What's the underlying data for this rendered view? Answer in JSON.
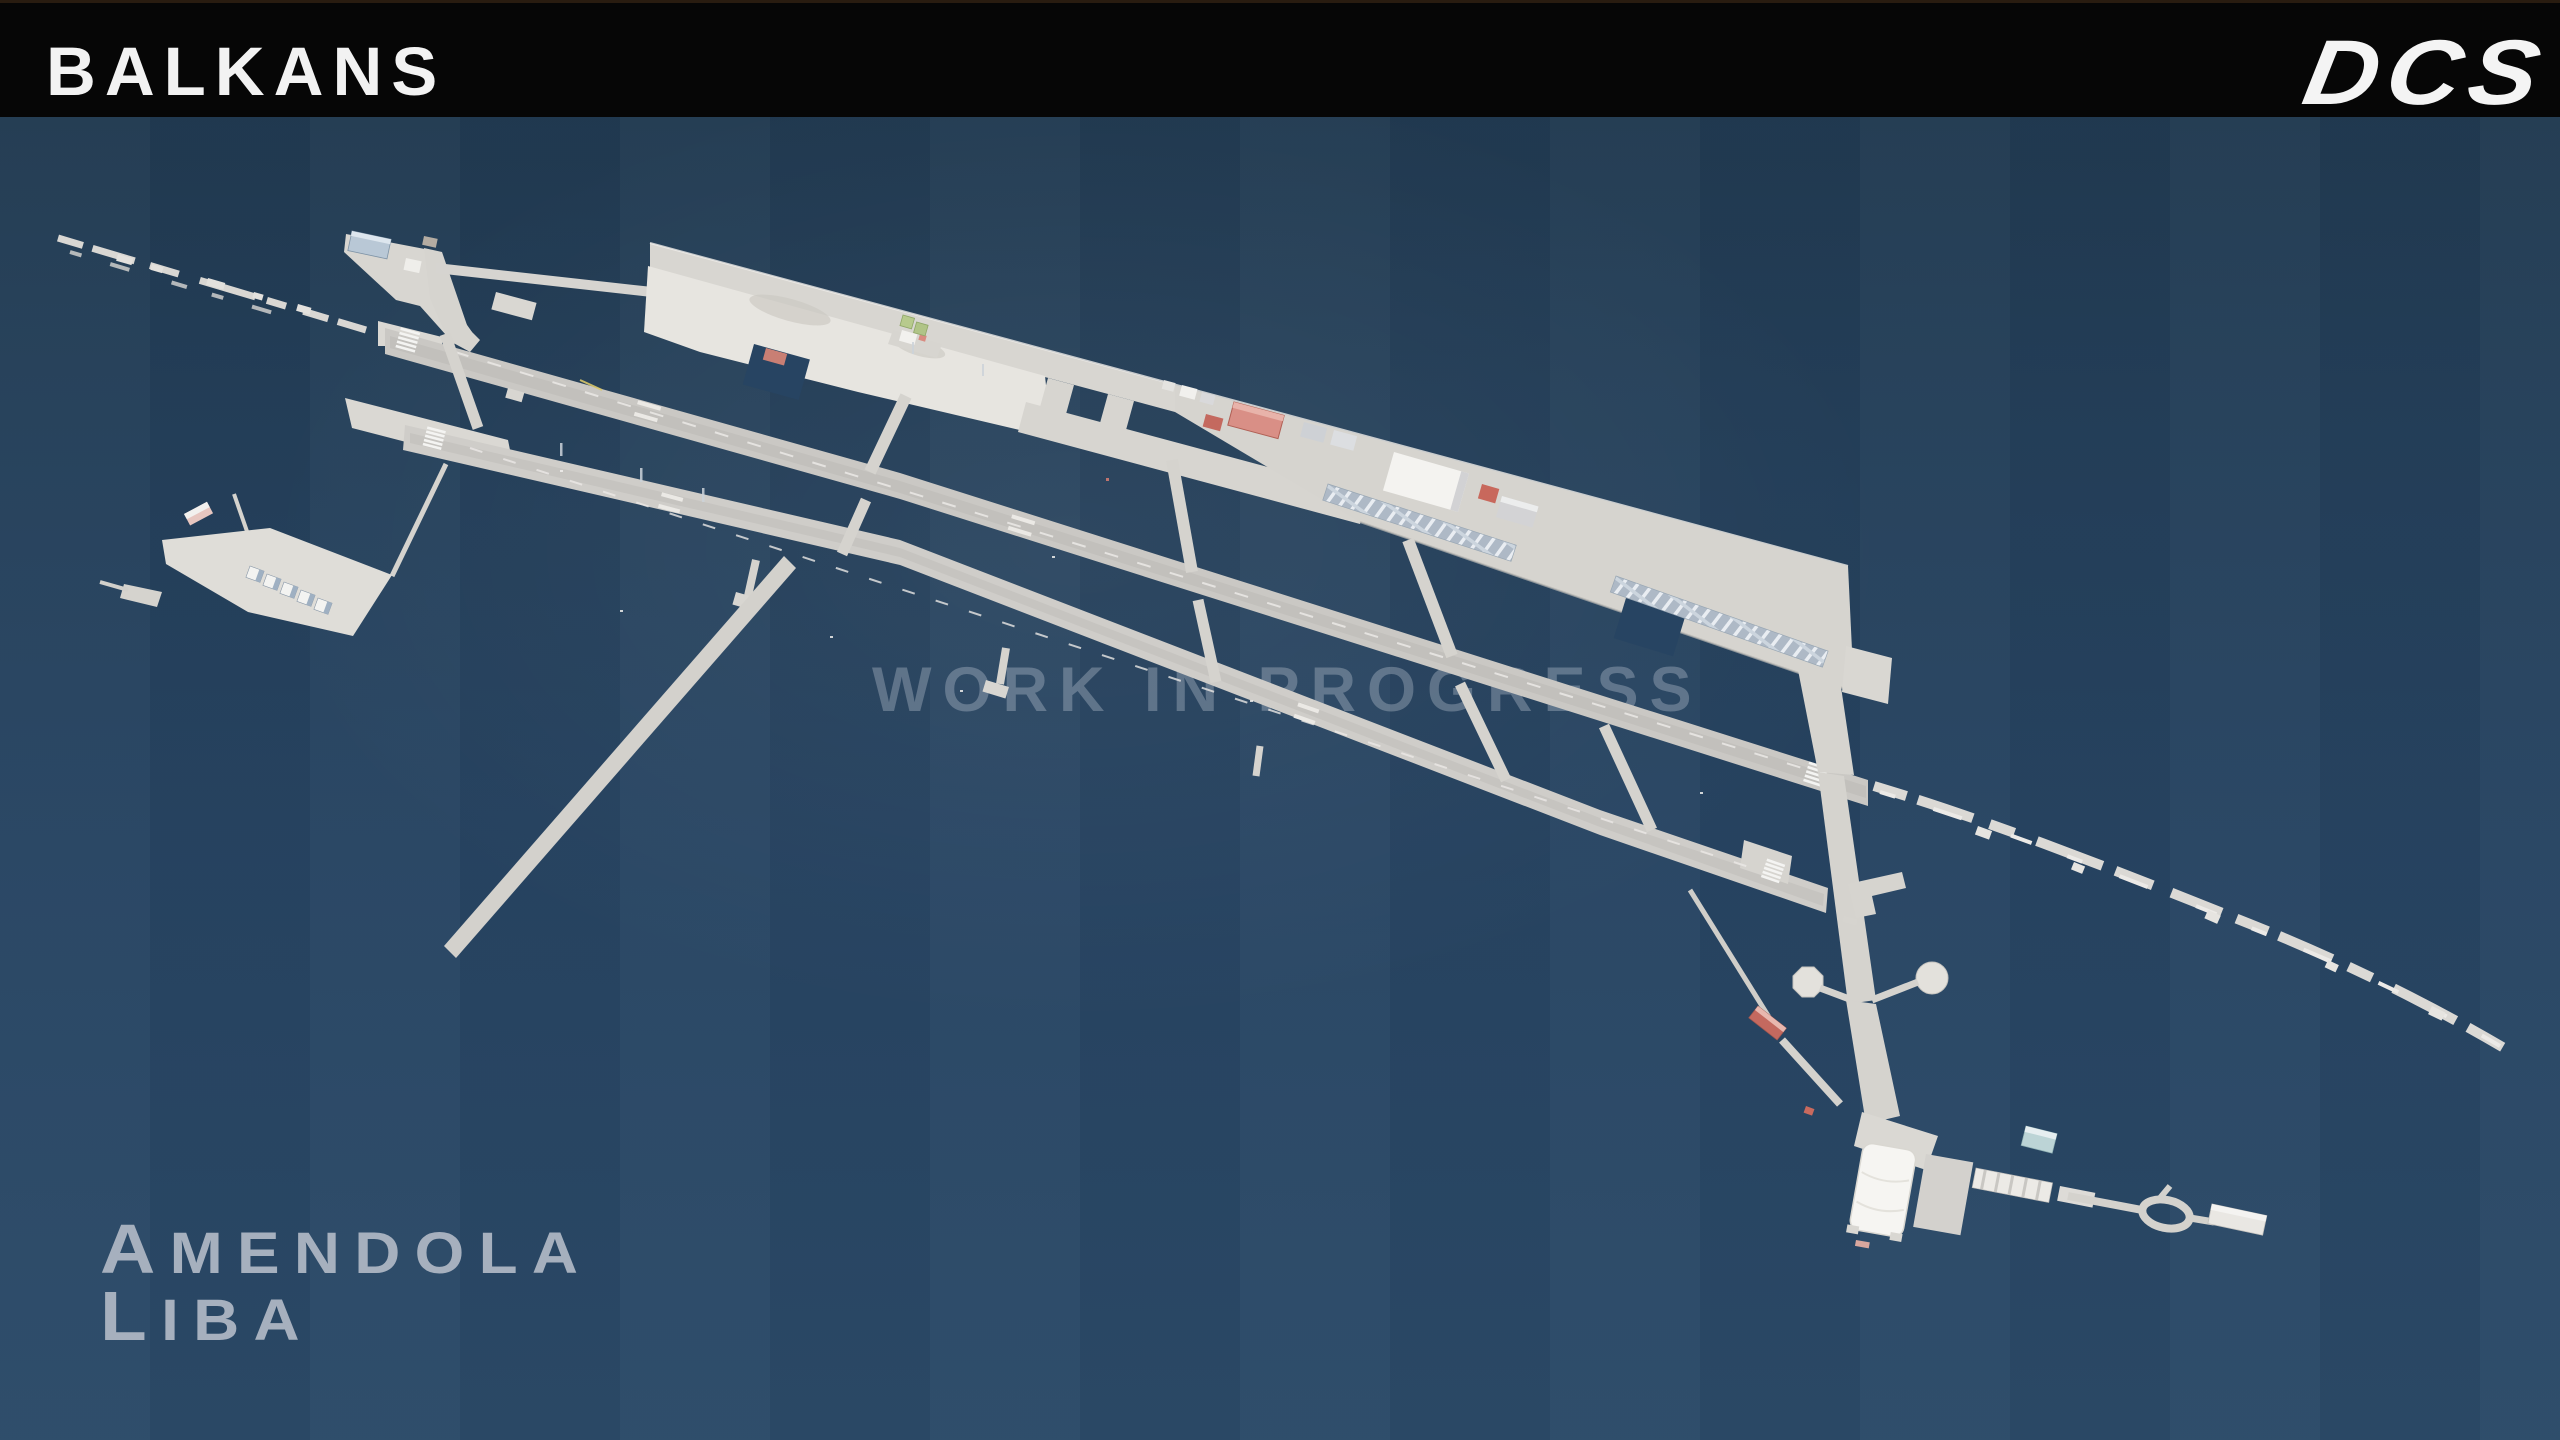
{
  "header": {
    "map_name": "BALKANS",
    "brand_logo": "DCS"
  },
  "watermark": {
    "text": "WORK IN PROGRESS"
  },
  "location_label": {
    "name": "Amendola",
    "icao": "Liba"
  },
  "scene": {
    "description": "Top-down aerial render of Amendola (LIBA) airbase on dark blue water-like background"
  },
  "theme": {
    "header_background": "#060606",
    "header_text": "#f2f2f2",
    "background_top": "#20384e",
    "background_bottom": "#2b4a68",
    "pavement": "#d5d3ce",
    "pavement_bright": "#e7e5e0",
    "runway_surface": "#cac8c4",
    "marking_white": "#f4f4f2",
    "red_roof": "#c4695f",
    "blue_roof": "#b9c8d6",
    "teal_roof": "#bcd4d6",
    "green_shelter": "#b7ca8d",
    "shelter_row": "#aeb9c6",
    "watermark_color": "rgba(236,242,247,0.27)",
    "location_text_color": "#a6b0be"
  }
}
